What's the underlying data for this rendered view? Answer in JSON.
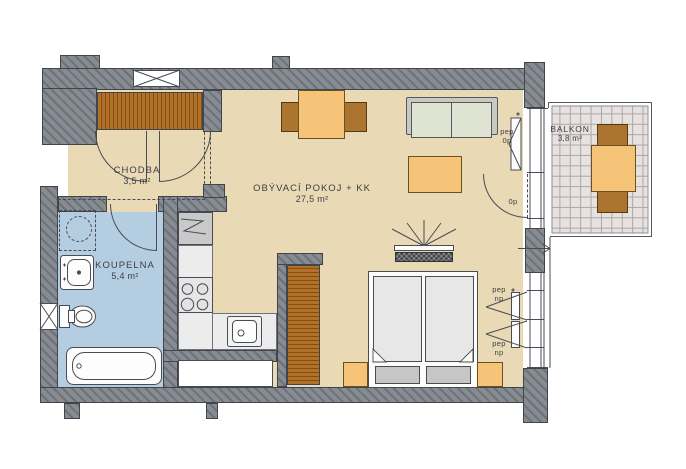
{
  "title": "Apartment floor plan",
  "rooms": [
    {
      "name": "CHODBA",
      "area": "3,5 m²"
    },
    {
      "name": "KOUPELNA",
      "area": "5,4 m²"
    },
    {
      "name": "OBÝVACÍ POKOJ + KK",
      "area": "27,5 m²"
    },
    {
      "name": "BALKON",
      "area": "3,8 m²"
    }
  ],
  "openings": {
    "balcony_window": [
      "pep",
      "0p"
    ],
    "balcony_door": [
      "0p"
    ],
    "window_lower_1": [
      "pep",
      "np"
    ],
    "window_lower_2": [
      "pep",
      "np"
    ]
  },
  "fixtures": [
    "washing-machine",
    "washbasin",
    "toilet",
    "bathtub",
    "ventilation-shaft",
    "hall-wardrobe",
    "fridge",
    "stove",
    "kitchen-sink",
    "kitchen-window",
    "dining-table",
    "dining-chair",
    "sofa",
    "coffee-table",
    "tv",
    "bedroom-wardrobe",
    "double-bed",
    "nightstand",
    "balcony-table",
    "balcony-chair",
    "entrance-arrow"
  ],
  "colors": {
    "wall_a": "#878b92",
    "wall_b": "#6d7178",
    "outline": "#40444b",
    "floor": "#e9d9b5",
    "bathroom": "#b5cde1",
    "wardrobe": "#b2702a",
    "wardrobe_line": "#81510f",
    "furniture_orange": "#f6c478",
    "furniture_brown": "#ab752f",
    "sofa_frame": "#c8c9c1",
    "sofa_cushion": "#dfe4d2",
    "counter": "#ececec",
    "appliance_gray": "#c9c9c9",
    "mattress": "#e7e7e7",
    "pillow": "#c6c6c6",
    "tile": "#e7e1df",
    "tile_line": "#aba7a5",
    "tv_dark": "#45484d",
    "ink": "#3c4046",
    "line": "#494d53"
  }
}
